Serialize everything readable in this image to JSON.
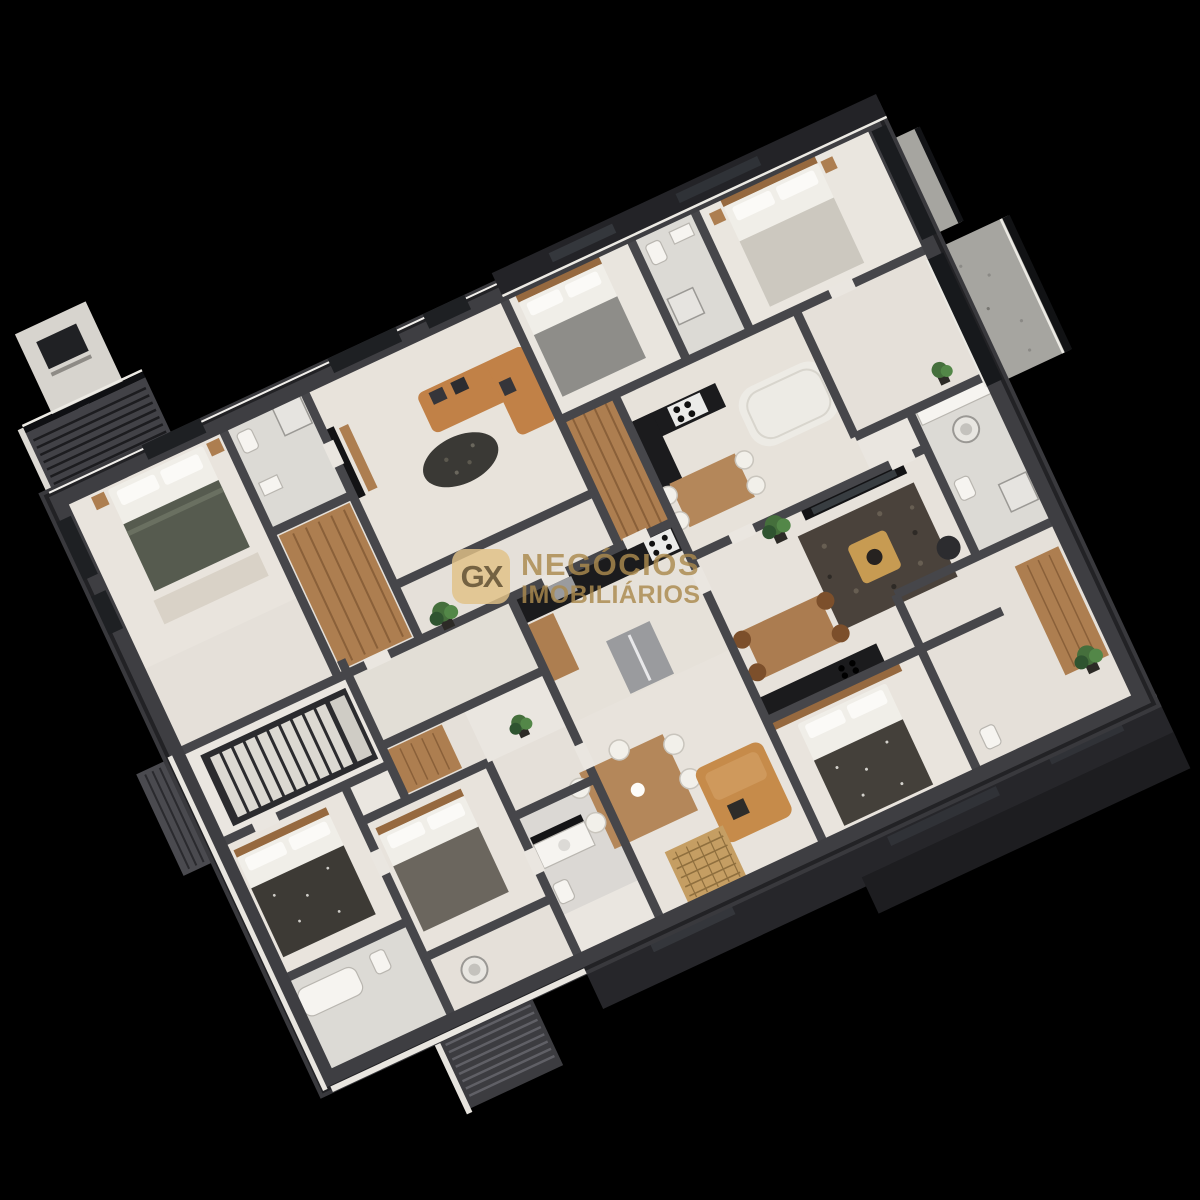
{
  "scene": {
    "description": "3D isometric cutaway floor plan rendering of a residential apartment floor (multiple units with bedrooms, bathrooms, kitchens, living rooms, balconies and a stair core) on a black background",
    "projection_rotation_deg": -25,
    "background": "#000000"
  },
  "watermark": {
    "logo": "GX",
    "line1": "NEGÓCIOS",
    "line2": "IMOBILIÁRIOS",
    "color": "#ab8a4e",
    "badge_fill": "#e2c287",
    "badge_text_color": "#5c4722"
  },
  "palette": {
    "bg": "#000000",
    "slab": "#39393d",
    "wall": "#46464a",
    "wallDark": "#222225",
    "facade": "#26262a",
    "facadeDeep": "#1d1d20",
    "floor": "#eae6e0",
    "floorWarm": "#e5e0d9",
    "floorLiving": "#e8e3dc",
    "tile": "#dcdad5",
    "trim": "#eceae4",
    "wood": "#ad7e50",
    "woodDark": "#8a6039",
    "woodTable": "#b4875a",
    "woodHead": "#96693f",
    "granite": "#a6a5a0",
    "glass": "#17191c",
    "counter": "#1b1b1d",
    "steel": "#9a9b9e",
    "sofaTan": "#c18147",
    "sofaTanB": "#c68b4a",
    "sofaWhite": "#edebe5",
    "bedWhite": "#f0eee8",
    "blanketGreen": "#565b4f",
    "blanketGray": "#8e8d89",
    "blanketLight": "#ccc8bf",
    "blanketDark": "#3d3a35",
    "blanketBrown": "#44403a",
    "rugDark": "#4a423b",
    "rugJute": "#c59e63",
    "rugLight": "#d9d2c7",
    "plant": "#456f3c",
    "plantDark": "#2f5430",
    "plantLight": "#538748",
    "gold": "#c79b52",
    "wm": "#ab8a4e",
    "wmBadgeBg": "#e2c287",
    "wmBadgeText": "#5c4722"
  }
}
